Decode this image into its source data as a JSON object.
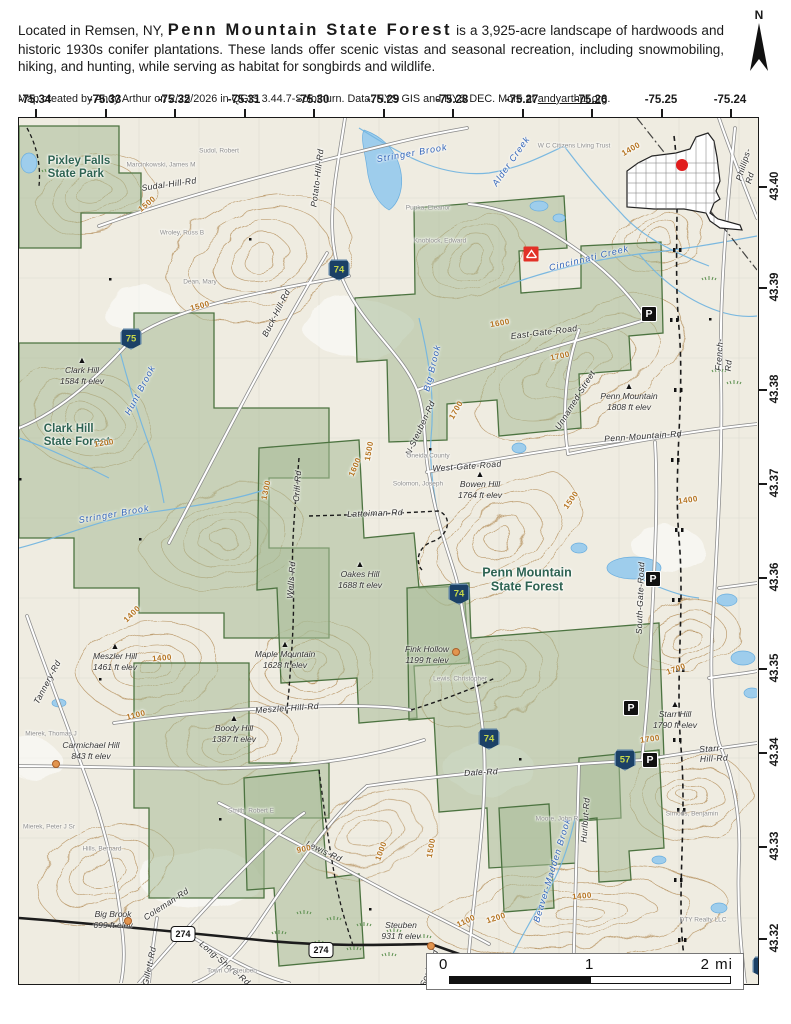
{
  "header": {
    "intro": "Located in Remsen, NY,",
    "title": "Penn Mountain State Forest",
    "body": "is a 3,925-acre landscape of hardwoods and historic 1930s conifer plantations. These lands offer scenic vistas and seasonal recreation, including snowmobiling, hiking, and hunting, while serving as habitat for songbirds and wildlife.",
    "north_label": "N"
  },
  "credit": {
    "prefix": "Map created by Andy Arthur on 2/25/2026 in QGIS 3.44.7-Solothurn. Data: NYS GIS and NYS DEC. More at",
    "link": "andyarthur.org",
    "suffix": "."
  },
  "axes": {
    "lon": [
      "-75.34",
      "-75.33",
      "-75.32",
      "-75.31",
      "-75.30",
      "-75.29",
      "-75.28",
      "-75.27",
      "-75.26",
      "-75.25",
      "-75.24"
    ],
    "lat": [
      "43.40",
      "43.39",
      "43.38",
      "43.37",
      "43.36",
      "43.35",
      "43.34",
      "43.33",
      "43.32"
    ]
  },
  "map": {
    "areas": [
      {
        "text": "Pixley Falls\nState Park"
      },
      {
        "text": "Clark Hill\nState Forest"
      },
      {
        "text": "Penn Mountain\nState Forest"
      }
    ],
    "peaks": [
      {
        "name": "Clark Hill",
        "elev": "1584 ft elev"
      },
      {
        "name": "Penn Mountain",
        "elev": "1808 ft elev"
      },
      {
        "name": "Bowen Hill",
        "elev": "1764 ft elev"
      },
      {
        "name": "Meszler Hill",
        "elev": "1461 ft elev"
      },
      {
        "name": "Oakes Hill",
        "elev": "1688 ft elev"
      },
      {
        "name": "Maple Mountain",
        "elev": "1628 ft elev"
      },
      {
        "name": "Boody Hill",
        "elev": "1387 ft elev"
      },
      {
        "name": "Starr Hill",
        "elev": "1790 ft elev"
      },
      {
        "name": "Fink Hollow",
        "elev": "1199 ft elev"
      },
      {
        "name": "Carmichael Hill",
        "elev": "843 ft elev"
      },
      {
        "name": "Big Brook",
        "elev": "699 ft elev"
      },
      {
        "name": "Steuben",
        "elev": "931 ft elev"
      }
    ],
    "roads": [
      {
        "label": "Sudal-Hill-Rd"
      },
      {
        "label": "Potato-Hill-Rd"
      },
      {
        "label": "Buck-Hill-Rd"
      },
      {
        "label": "N-Steuben-Rd"
      },
      {
        "label": "East-Gate-Road"
      },
      {
        "label": "Unnamed-Street"
      },
      {
        "label": "Penn-Mountain-Rd"
      },
      {
        "label": "West-Gate-Road"
      },
      {
        "label": "Phillips-Rd"
      },
      {
        "label": "French-Rd"
      },
      {
        "label": "Latteiman-Rd"
      },
      {
        "label": "Crill-Rd"
      },
      {
        "label": "Wells-Rd"
      },
      {
        "label": "Meszler-Hill-Rd"
      },
      {
        "label": "Tannery-Rd"
      },
      {
        "label": "South-Gate-Road"
      },
      {
        "label": "Dale-Rd"
      },
      {
        "label": "Hurlbut-Rd"
      },
      {
        "label": "Starr-Hill-Rd"
      },
      {
        "label": "Lewis-Rd"
      },
      {
        "label": "Coleman-Rd"
      },
      {
        "label": "Long-Shore-Rd"
      },
      {
        "label": "Gillett-Rd"
      },
      {
        "label": "Soule-Rd"
      }
    ],
    "streams": [
      {
        "label": "Stringer Brook"
      },
      {
        "label": "Alder Creek"
      },
      {
        "label": "Cincinnati Creek"
      },
      {
        "label": "Stringer Brook"
      },
      {
        "label": "Hunt Brook"
      },
      {
        "label": "Big Brook"
      },
      {
        "label": "Beaver-Madden Brook"
      }
    ],
    "contours": [
      "1500",
      "1500",
      "1400",
      "1600",
      "1700",
      "1200",
      "1300",
      "1500",
      "1600",
      "1700",
      "1400",
      "1400",
      "1500",
      "1400",
      "1700",
      "1700",
      "1500",
      "900",
      "1000",
      "1100",
      "1100",
      "1200",
      "1400"
    ],
    "parcels": [
      "Sudol, Robert",
      "Marcinkowski, James M",
      "Wroley, Russ B",
      "Dean, Mary",
      "Pupka, Eleanor",
      "Knoblock, Edward",
      "W C Citizens Living Trust",
      "Oneida County",
      "Solomon, Joseph",
      "Lewis, Christopher",
      "Moore, John R",
      "Hills, Bernard",
      "Mierek, Peter J Sr",
      "Mierek, Thomas J",
      "Simons, Benjamin",
      "Smith, Robert E",
      "DTY Realty LLC",
      "Town Of Steuben"
    ],
    "shields": [
      {
        "num": "74"
      },
      {
        "num": "75"
      },
      {
        "num": "74"
      },
      {
        "num": "74"
      },
      {
        "num": "57"
      },
      {
        "num": "53"
      },
      {
        "num": "274"
      },
      {
        "num": "274"
      }
    ],
    "parking_label": "P"
  },
  "scalebar": {
    "zero": "0",
    "one": "1",
    "two": "2 mi"
  }
}
